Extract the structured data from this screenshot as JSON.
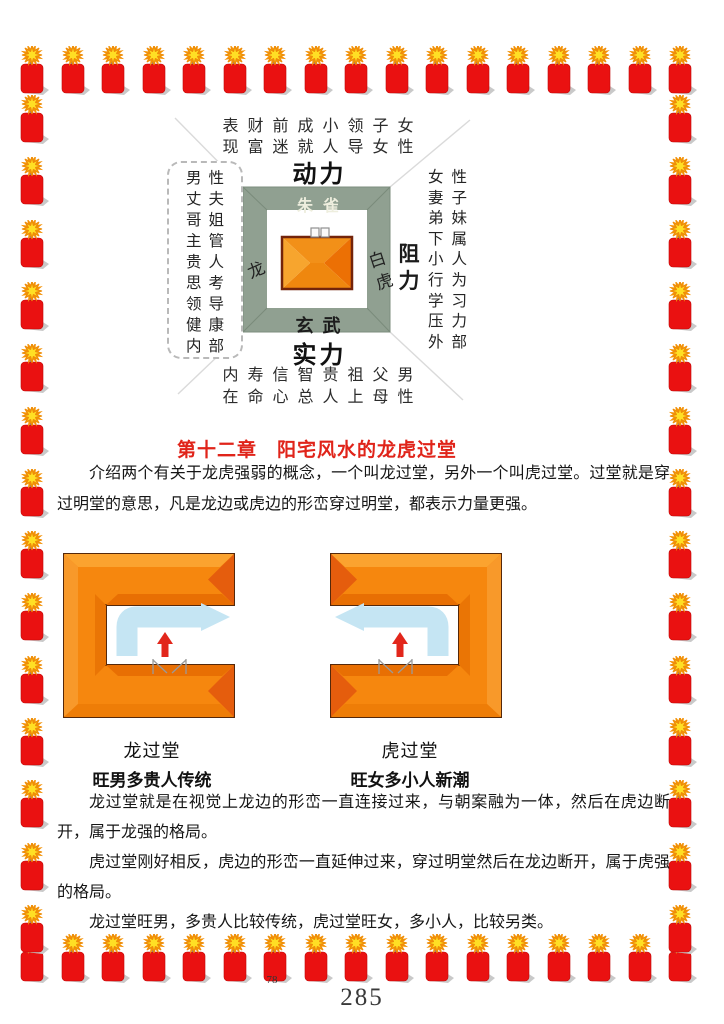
{
  "compass": {
    "top_line1": "表财前成小领子女",
    "top_line2": "现富迷就人导女性",
    "label_top": "动力",
    "label_bottom": "实力",
    "label_left": "助力",
    "label_right": "阻力",
    "inner_top": "朱雀",
    "inner_bottom": "玄武",
    "inner_left": "龙",
    "inner_right": "白虎",
    "left_box_rows": [
      "男性",
      "丈夫",
      "哥姐",
      "主管",
      "贵人",
      "思考",
      "领导",
      "健康",
      "内部"
    ],
    "right_rows": [
      "女性",
      "妻子",
      "弟妹",
      "下属",
      "小人",
      "行为",
      "学习",
      "压力",
      "外部"
    ],
    "bottom_line1": "内寿信智贵祖父男",
    "bottom_line2": "在命心总人上母性"
  },
  "chapter": {
    "title": "第十二章　阳宅风水的龙虎过堂"
  },
  "paragraphs": {
    "p1": "介绍两个有关于龙虎强弱的概念，一个叫龙过堂，另外一个叫虎过堂。过堂就是穿过明堂的意思，凡是龙边或虎边的形峦穿过明堂，都表示力量更强。",
    "p2": "龙过堂就是在视觉上龙边的形峦一直连接过来，与朝案融为一体，然后在虎边断开，属于龙强的格局。",
    "p3": "虎过堂刚好相反，虎边的形峦一直延伸过来，穿过明堂然后在龙边断开，属于虎强的格局。",
    "p4": "龙过堂旺男，多贵人比较传统，虎过堂旺女，多小人，比较另类。"
  },
  "figures": {
    "left": {
      "caption": "龙过堂",
      "subcaption": "旺男多贵人传统"
    },
    "right": {
      "caption": "虎过堂",
      "subcaption": "旺女多小人新潮"
    }
  },
  "page": {
    "inner_number": "78",
    "number": "285"
  },
  "colors": {
    "accent_red": "#e0241a",
    "frame_green": "#90a091",
    "orange": "#f6870e",
    "arrow_blue": "#c5e5f3",
    "firecracker_red": "#ea1111",
    "star_yellow": "#ffdf24"
  }
}
